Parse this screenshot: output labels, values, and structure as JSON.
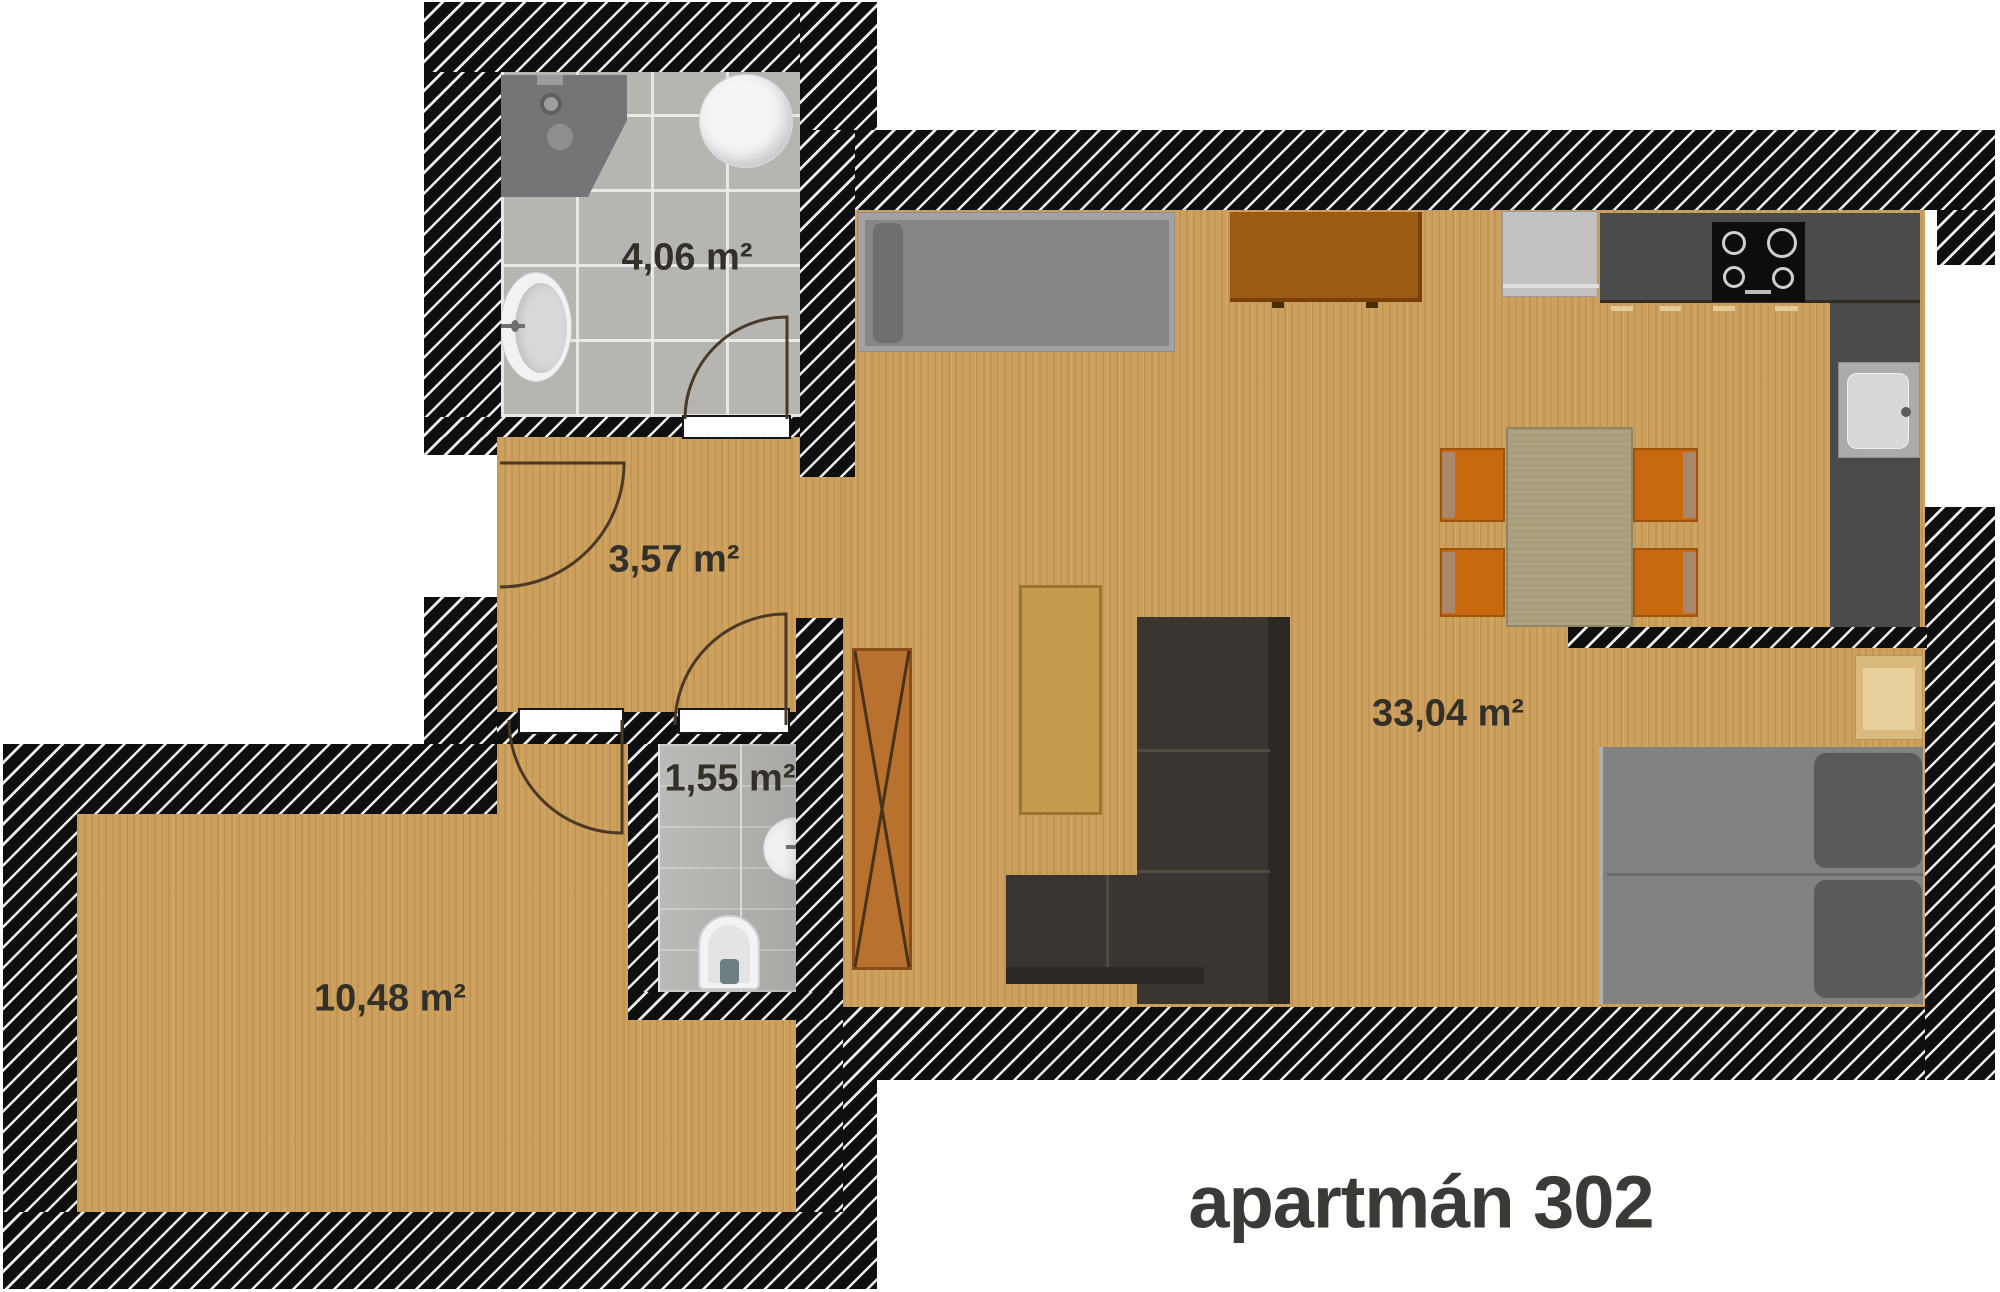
{
  "title": "apartmán 302",
  "plan": {
    "rooms": [
      {
        "id": "bathroom",
        "label": "4,06 m²",
        "area_m2": 4.06
      },
      {
        "id": "hallway",
        "label": "3,57 m²",
        "area_m2": 3.57
      },
      {
        "id": "wc",
        "label": "1,55 m²",
        "area_m2": 1.55
      },
      {
        "id": "room",
        "label": "10,48 m²",
        "area_m2": 10.48
      },
      {
        "id": "living-kitchen",
        "label": "33,04 m²",
        "area_m2": 33.04
      }
    ]
  },
  "fixtures": [
    "shower",
    "boiler",
    "washbasin",
    "toilet",
    "corner-sink",
    "single-bed",
    "dresser",
    "fridge",
    "kitchen-counter",
    "cooktop",
    "kitchen-sink",
    "dining-table",
    "chair",
    "wardrobe",
    "coffee-table",
    "corner-sofa",
    "double-bed",
    "nightstand"
  ],
  "colors": {
    "wall": "#0f0f0f",
    "wall_stripe": "#ececec",
    "wood_floor": "#cda15d",
    "tile_floor": "#b7b5b1",
    "counter": "#4b4b4b",
    "chair_orange": "#c8690f",
    "dresser_brown": "#9c5a12",
    "sofa_charcoal": "#3a3530",
    "bed_gray": "#828282",
    "table_khaki": "#a89d7b",
    "wardrobe_orange": "#b9712f",
    "label_text": "#332f29",
    "title_text": "#3c3a36"
  }
}
